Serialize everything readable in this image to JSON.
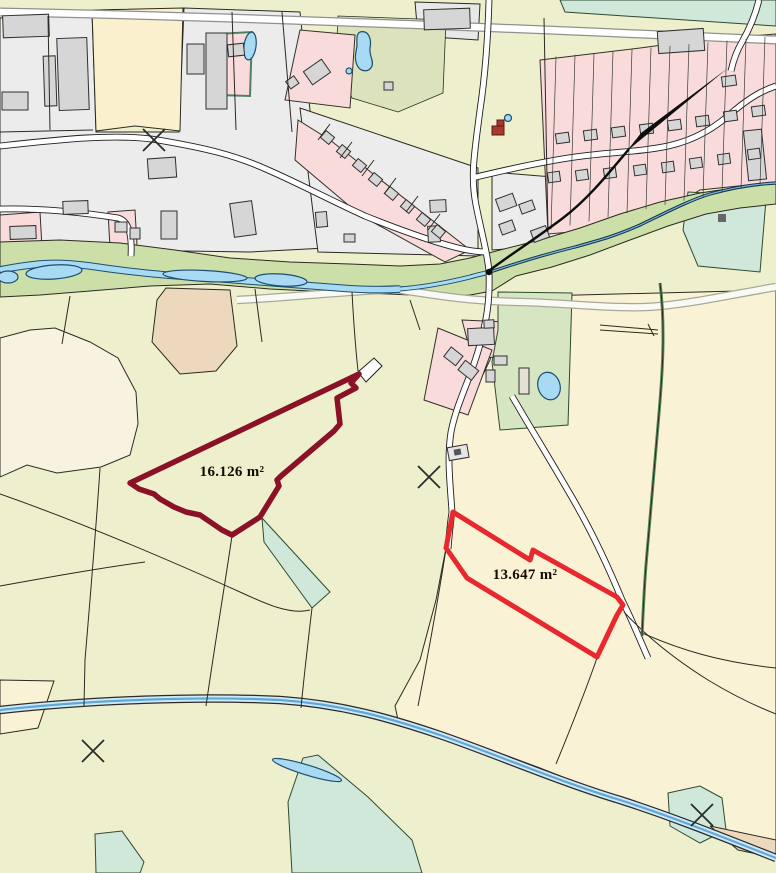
{
  "map": {
    "name": "cadastral-parcel-map",
    "highlighted_parcels": [
      {
        "id": "west-parcel",
        "area_label": "16.126 m²",
        "outline_color": "#8a1126"
      },
      {
        "id": "east-parcel",
        "area_label": "13.647 m²",
        "outline_color": "#e8282e"
      }
    ],
    "symbols": {
      "cross_marks": 4,
      "leader_arrows": 1
    },
    "colors": {
      "field": "#eef0cd",
      "cream_field": "#faf2d5",
      "meadow_corridor": "#ccdfa8",
      "pasture_green": "#cfe8d9",
      "farm_green": "#d6e6c3",
      "tan_field": "#ecd9bd",
      "urban_gray": "#ececec",
      "residential_pink": "#f8dbda",
      "building_gray": "#d6d6d6",
      "water_blue": "#a9daf3",
      "road_white": "#ffffff"
    }
  }
}
